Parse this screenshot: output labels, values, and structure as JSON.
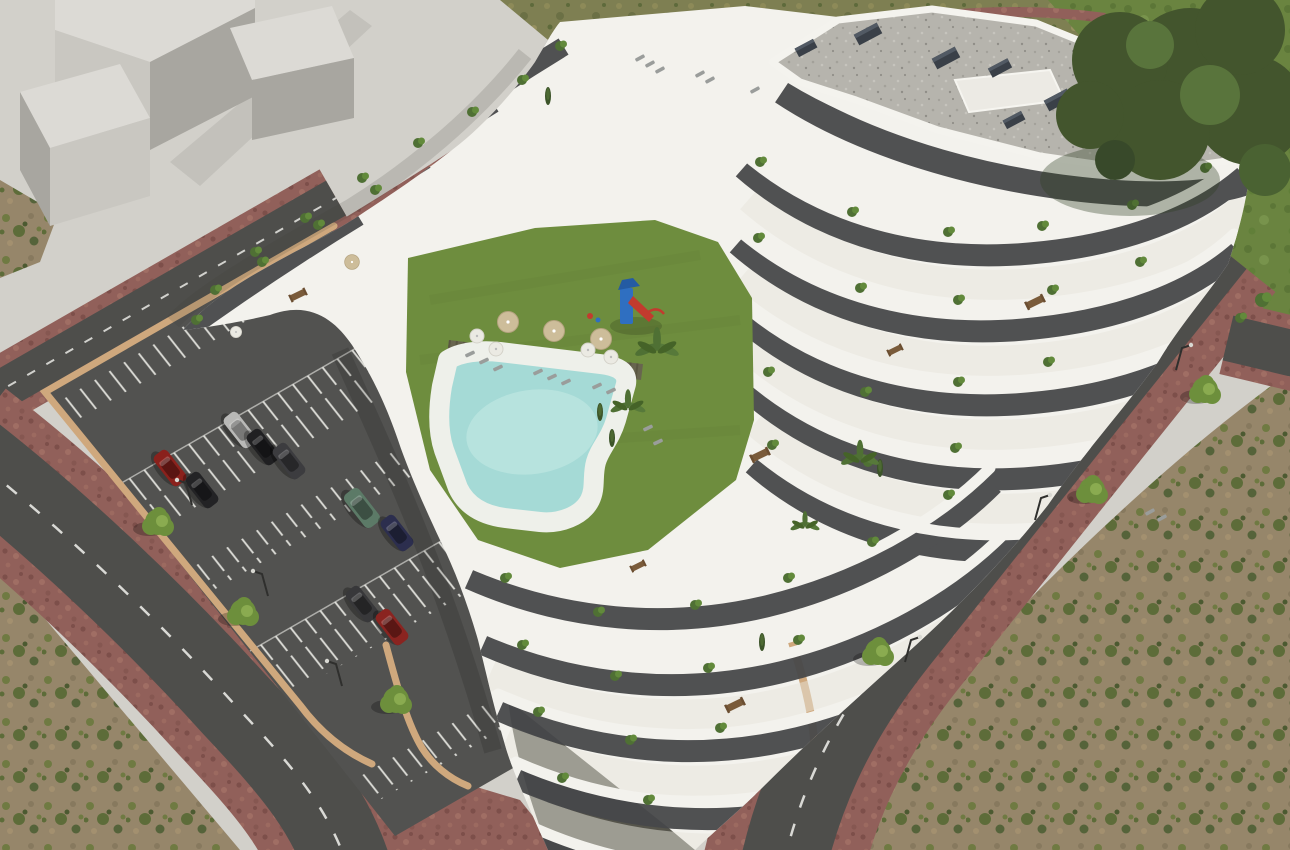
{
  "meta": {
    "description": "High-angle aerial 3D architectural rendering of a white terraced apartment complex with communal lawn courtyard, free-form swimming pool, playground, walled private parking lot, perimeter streets with red paver sidewalks, street trees and surrounding scrubland. Abstract light-grey massing blocks occupy the plaza at the upper left.",
    "style": "photorealistic CGI visualization",
    "view": "aerial oblique"
  },
  "colors": {
    "plaza": "#d2d0ca",
    "block_top": "#dcdad5",
    "block_front": "#c9c7c1",
    "block_side": "#a8a6a0",
    "dry_grass": "#7e7f52",
    "grass_green": "#6a8440",
    "scrub_dirt": "#96866a",
    "scrub_green": "#5d6c39",
    "asphalt": "#4e4e4b",
    "road_marking": "#e9e9e4",
    "brick": "#91605a",
    "concrete_walk": "#cbc9c2",
    "parking_asphalt": "#525250",
    "wall_tan": "#cfa87d",
    "building_white": "#f3f2ed",
    "facade_dark": "#47484a",
    "terrace_floor": "#e7e4db",
    "base_wall": "#55544b",
    "roof_gravel": "#b6b4ad",
    "roof_vent": "#3a4048",
    "lawn": "#6e8d3e",
    "pool_water": "#a5dad6",
    "pool_deck": "#eef0ea",
    "deck_wood": "#68654f",
    "tree_green": "#6d8f3c",
    "tree_dark": "#43552d",
    "palm_green": "#4f7034",
    "umbrella_tan": "#cdbd9a",
    "umbrella_white": "#ebeae3",
    "lounger_grey": "#9a9d9b",
    "furniture_wood": "#7a5b3a",
    "play_blue": "#2f6fc1",
    "play_red": "#c23b2e",
    "lamp": "#2f2f2d"
  },
  "scene": {
    "building": {
      "label": "terraced apartment building",
      "roof": "grey gravel flat roof with vents",
      "facade": "white curved balcony bands with dark recessed glazing and terrace planting"
    },
    "courtyard": {
      "lawn": "communal lawn",
      "pool": "free-form swimming pool with white deck",
      "playground": {
        "tower_color": "#2f6fc1",
        "slide_color": "#c23b2e"
      },
      "umbrellas": {
        "tan": 3,
        "white": 4
      },
      "sun_loungers": 8
    },
    "parking": {
      "label": "walled surface parking lot",
      "wall_color": "#cfa87d",
      "cars": [
        {
          "label": "silver car",
          "color": "#b9b9b7"
        },
        {
          "label": "black car",
          "color": "#202022"
        },
        {
          "label": "graphite car",
          "color": "#3c3c3f"
        },
        {
          "label": "green suv",
          "color": "#5c7a67"
        },
        {
          "label": "navy car",
          "color": "#2c2e4e"
        },
        {
          "label": "red car",
          "color": "#8a211c"
        },
        {
          "label": "black car",
          "color": "#232325"
        },
        {
          "label": "graphite car",
          "color": "#38383a"
        },
        {
          "label": "red car",
          "color": "#8a2420"
        }
      ]
    },
    "roads": {
      "label": "perimeter streets with dashed centre lines and red paver sidewalks"
    },
    "vegetation": {
      "street_trees": 6,
      "corner_tree": 1,
      "scrub": "dirt with green patches"
    }
  }
}
